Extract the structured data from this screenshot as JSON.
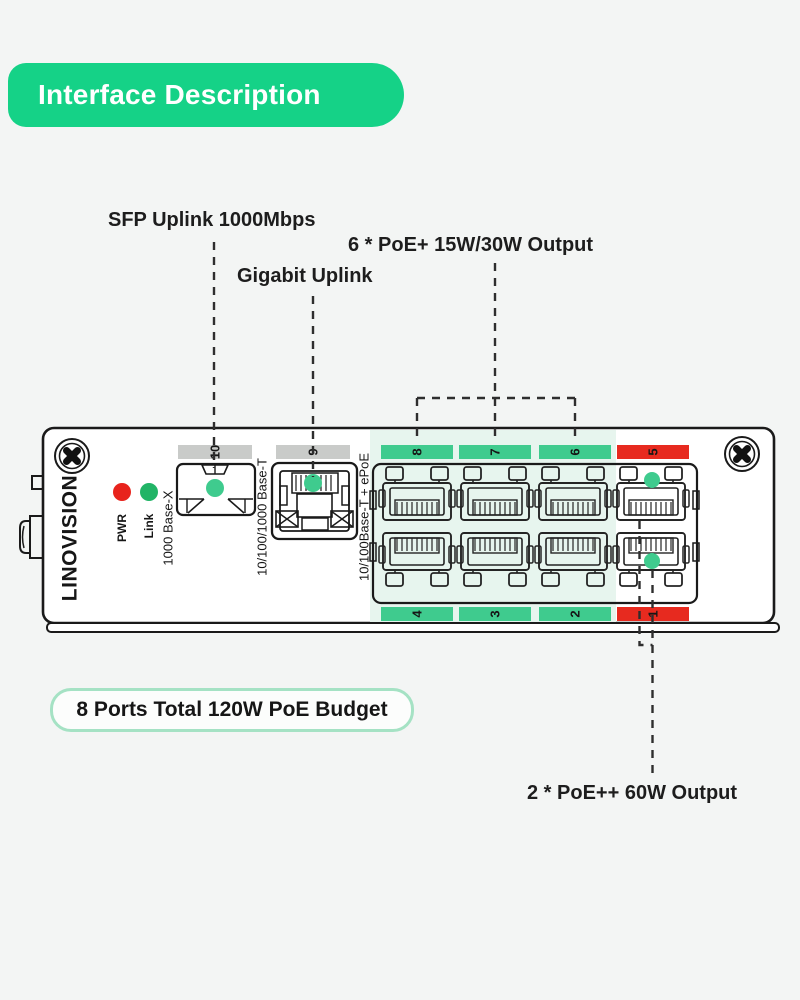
{
  "page": {
    "background": "#f3f5f4"
  },
  "header": {
    "title": "Interface Description"
  },
  "callouts": {
    "sfp": {
      "text": "SFP Uplink 1000Mbps"
    },
    "gigabit": {
      "text": "Gigabit Uplink"
    },
    "poe_plus": {
      "text": "6 * PoE+ 15W/30W Output"
    },
    "poe_plus_plus": {
      "text": "2 * PoE++ 60W Output"
    },
    "budget": {
      "text": "8 Ports Total 120W PoE Budget"
    }
  },
  "device": {
    "brand": "LINOVISION",
    "leds": {
      "pwr": "PWR",
      "link": "Link"
    },
    "uplinks": {
      "sfp": {
        "number": "10",
        "type": "1000 Base-X"
      },
      "rj45": {
        "number": "9",
        "type": "10/100/1000 Base-T"
      }
    },
    "poe_ports_label": "10/100Base-T + ePoE",
    "ports_top": [
      "8",
      "7",
      "6",
      "5"
    ],
    "ports_bottom": [
      "4",
      "3",
      "2",
      "1"
    ]
  },
  "colors": {
    "header_green": "#15d287",
    "bar_green": "#3fcb8e",
    "bar_red": "#e72a1f",
    "bar_gray": "#c9cbc9",
    "led_red": "#e8231c",
    "led_green": "#21b466",
    "dot_green": "#3fcb8e",
    "poe_zone_tint": "#e7f5ee",
    "budget_border": "#a5e2c4"
  }
}
